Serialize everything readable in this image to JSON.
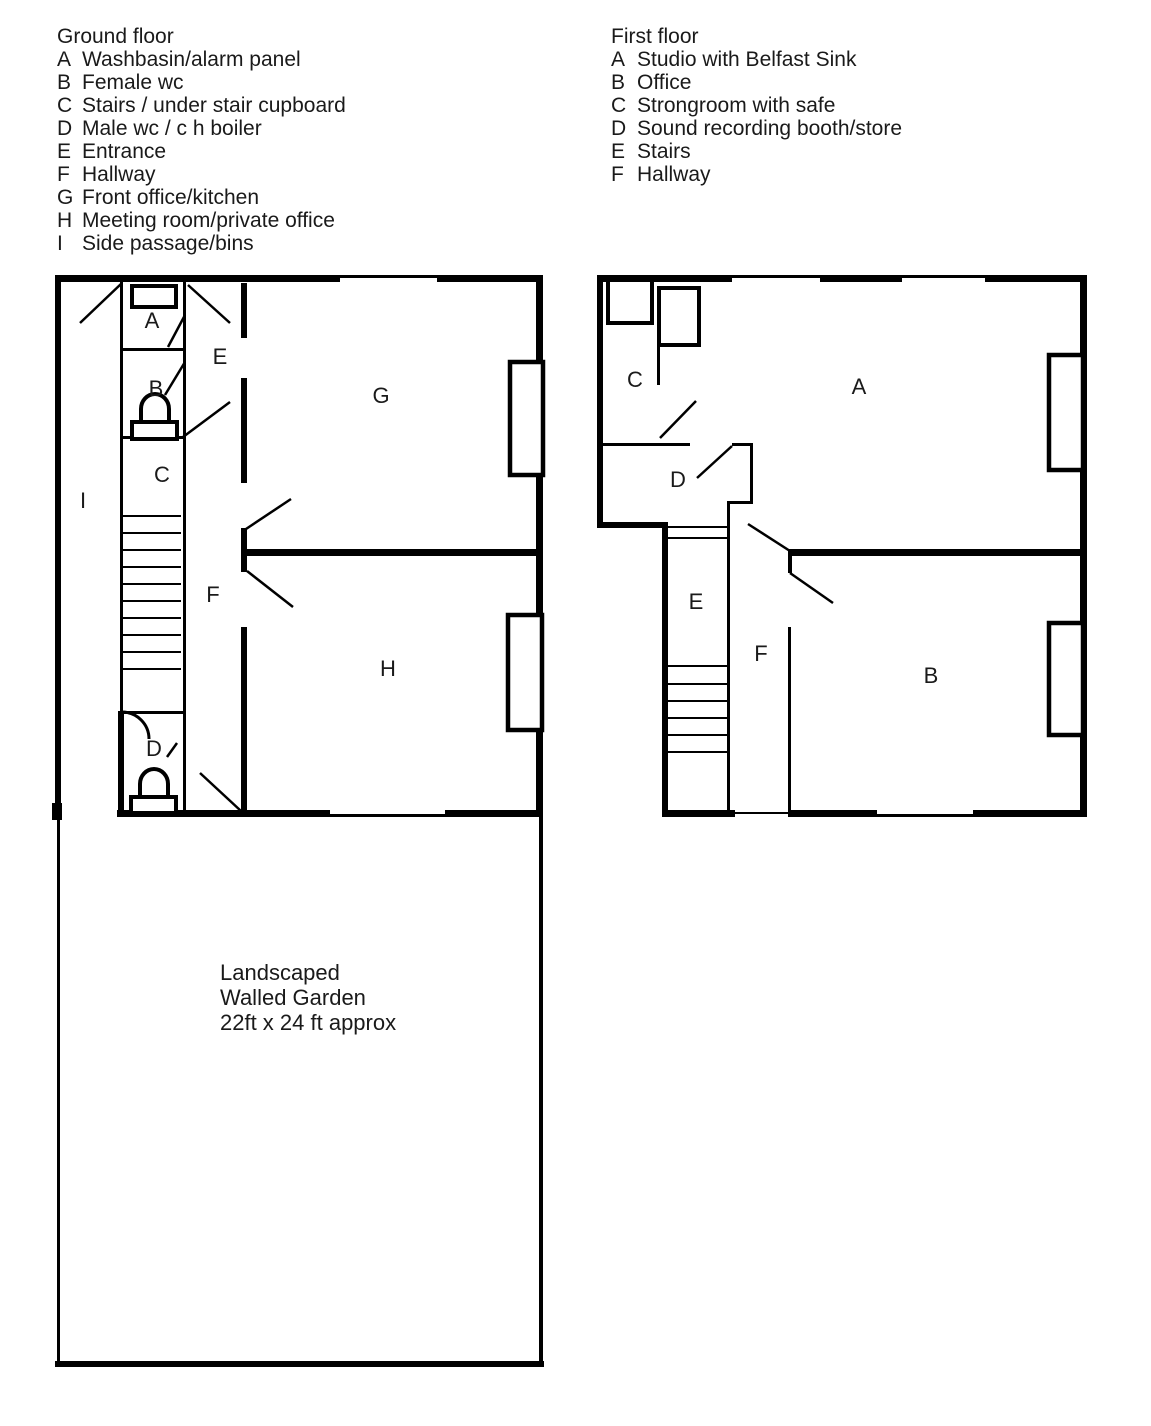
{
  "colors": {
    "ink": "#000000",
    "paper": "#ffffff"
  },
  "ground_floor": {
    "title": "Ground floor",
    "legend": [
      {
        "key": "A",
        "label": "Washbasin/alarm panel"
      },
      {
        "key": "B",
        "label": "Female wc"
      },
      {
        "key": "C",
        "label": "Stairs / under stair cupboard"
      },
      {
        "key": "D",
        "label": "Male wc / c h boiler"
      },
      {
        "key": "E",
        "label": "Entrance"
      },
      {
        "key": "F",
        "label": "Hallway"
      },
      {
        "key": "G",
        "label": "Front office/kitchen"
      },
      {
        "key": "H",
        "label": "Meeting room/private office"
      },
      {
        "key": "I",
        "label": "Side passage/bins"
      }
    ],
    "plan_labels": {
      "A": "A",
      "B": "B",
      "C": "C",
      "D": "D",
      "E": "E",
      "F": "F",
      "G": "G",
      "H": "H",
      "I": "I"
    }
  },
  "first_floor": {
    "title": "First floor",
    "legend": [
      {
        "key": "A",
        "label": "Studio with Belfast Sink"
      },
      {
        "key": "B",
        "label": "Office"
      },
      {
        "key": "C",
        "label": "Strongroom with safe"
      },
      {
        "key": "D",
        "label": "Sound recording booth/store"
      },
      {
        "key": "E",
        "label": "Stairs"
      },
      {
        "key": "F",
        "label": "Hallway"
      }
    ],
    "plan_labels": {
      "A": "A",
      "B": "B",
      "C": "C",
      "D": "D",
      "E": "E",
      "F": "F"
    }
  },
  "garden": {
    "lines": [
      "Landscaped",
      "Walled Garden",
      "22ft x 24 ft approx"
    ]
  }
}
